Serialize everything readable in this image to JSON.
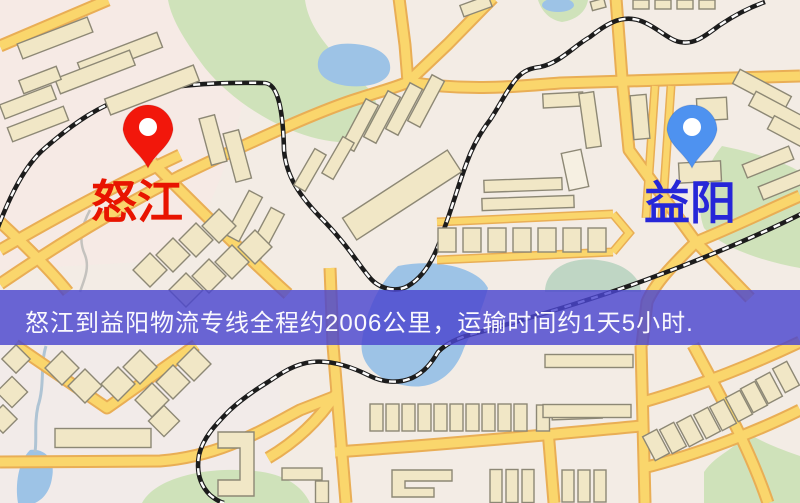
{
  "map": {
    "origin_marker": {
      "icon": "location-pin-icon",
      "label": "怒江",
      "pin_color": "#F2170B",
      "label_color": "#E81400"
    },
    "destination_marker": {
      "icon": "location-pin-icon",
      "label": "益阳",
      "pin_color": "#4E92F0",
      "label_color": "#2626D8"
    },
    "info_banner": {
      "text": "怒江到益阳物流专线全程约2006公里，运输时间约1天5小时.",
      "background": "rgba(74,70,206,0.82)",
      "text_color": "#FAF9FD"
    },
    "route": {
      "origin": "怒江",
      "destination": "益阳",
      "distance_text": "约2006公里",
      "duration_text": "约1天5小时"
    },
    "palette": {
      "road_fill": "#FAD66C",
      "road_casing": "#E9AE55",
      "railway": "#1C1C1C",
      "water": "#9DC3E6",
      "park": "#CFE2BA",
      "building_fill": "#F1E7C6",
      "background": "#F3ECE5"
    }
  }
}
